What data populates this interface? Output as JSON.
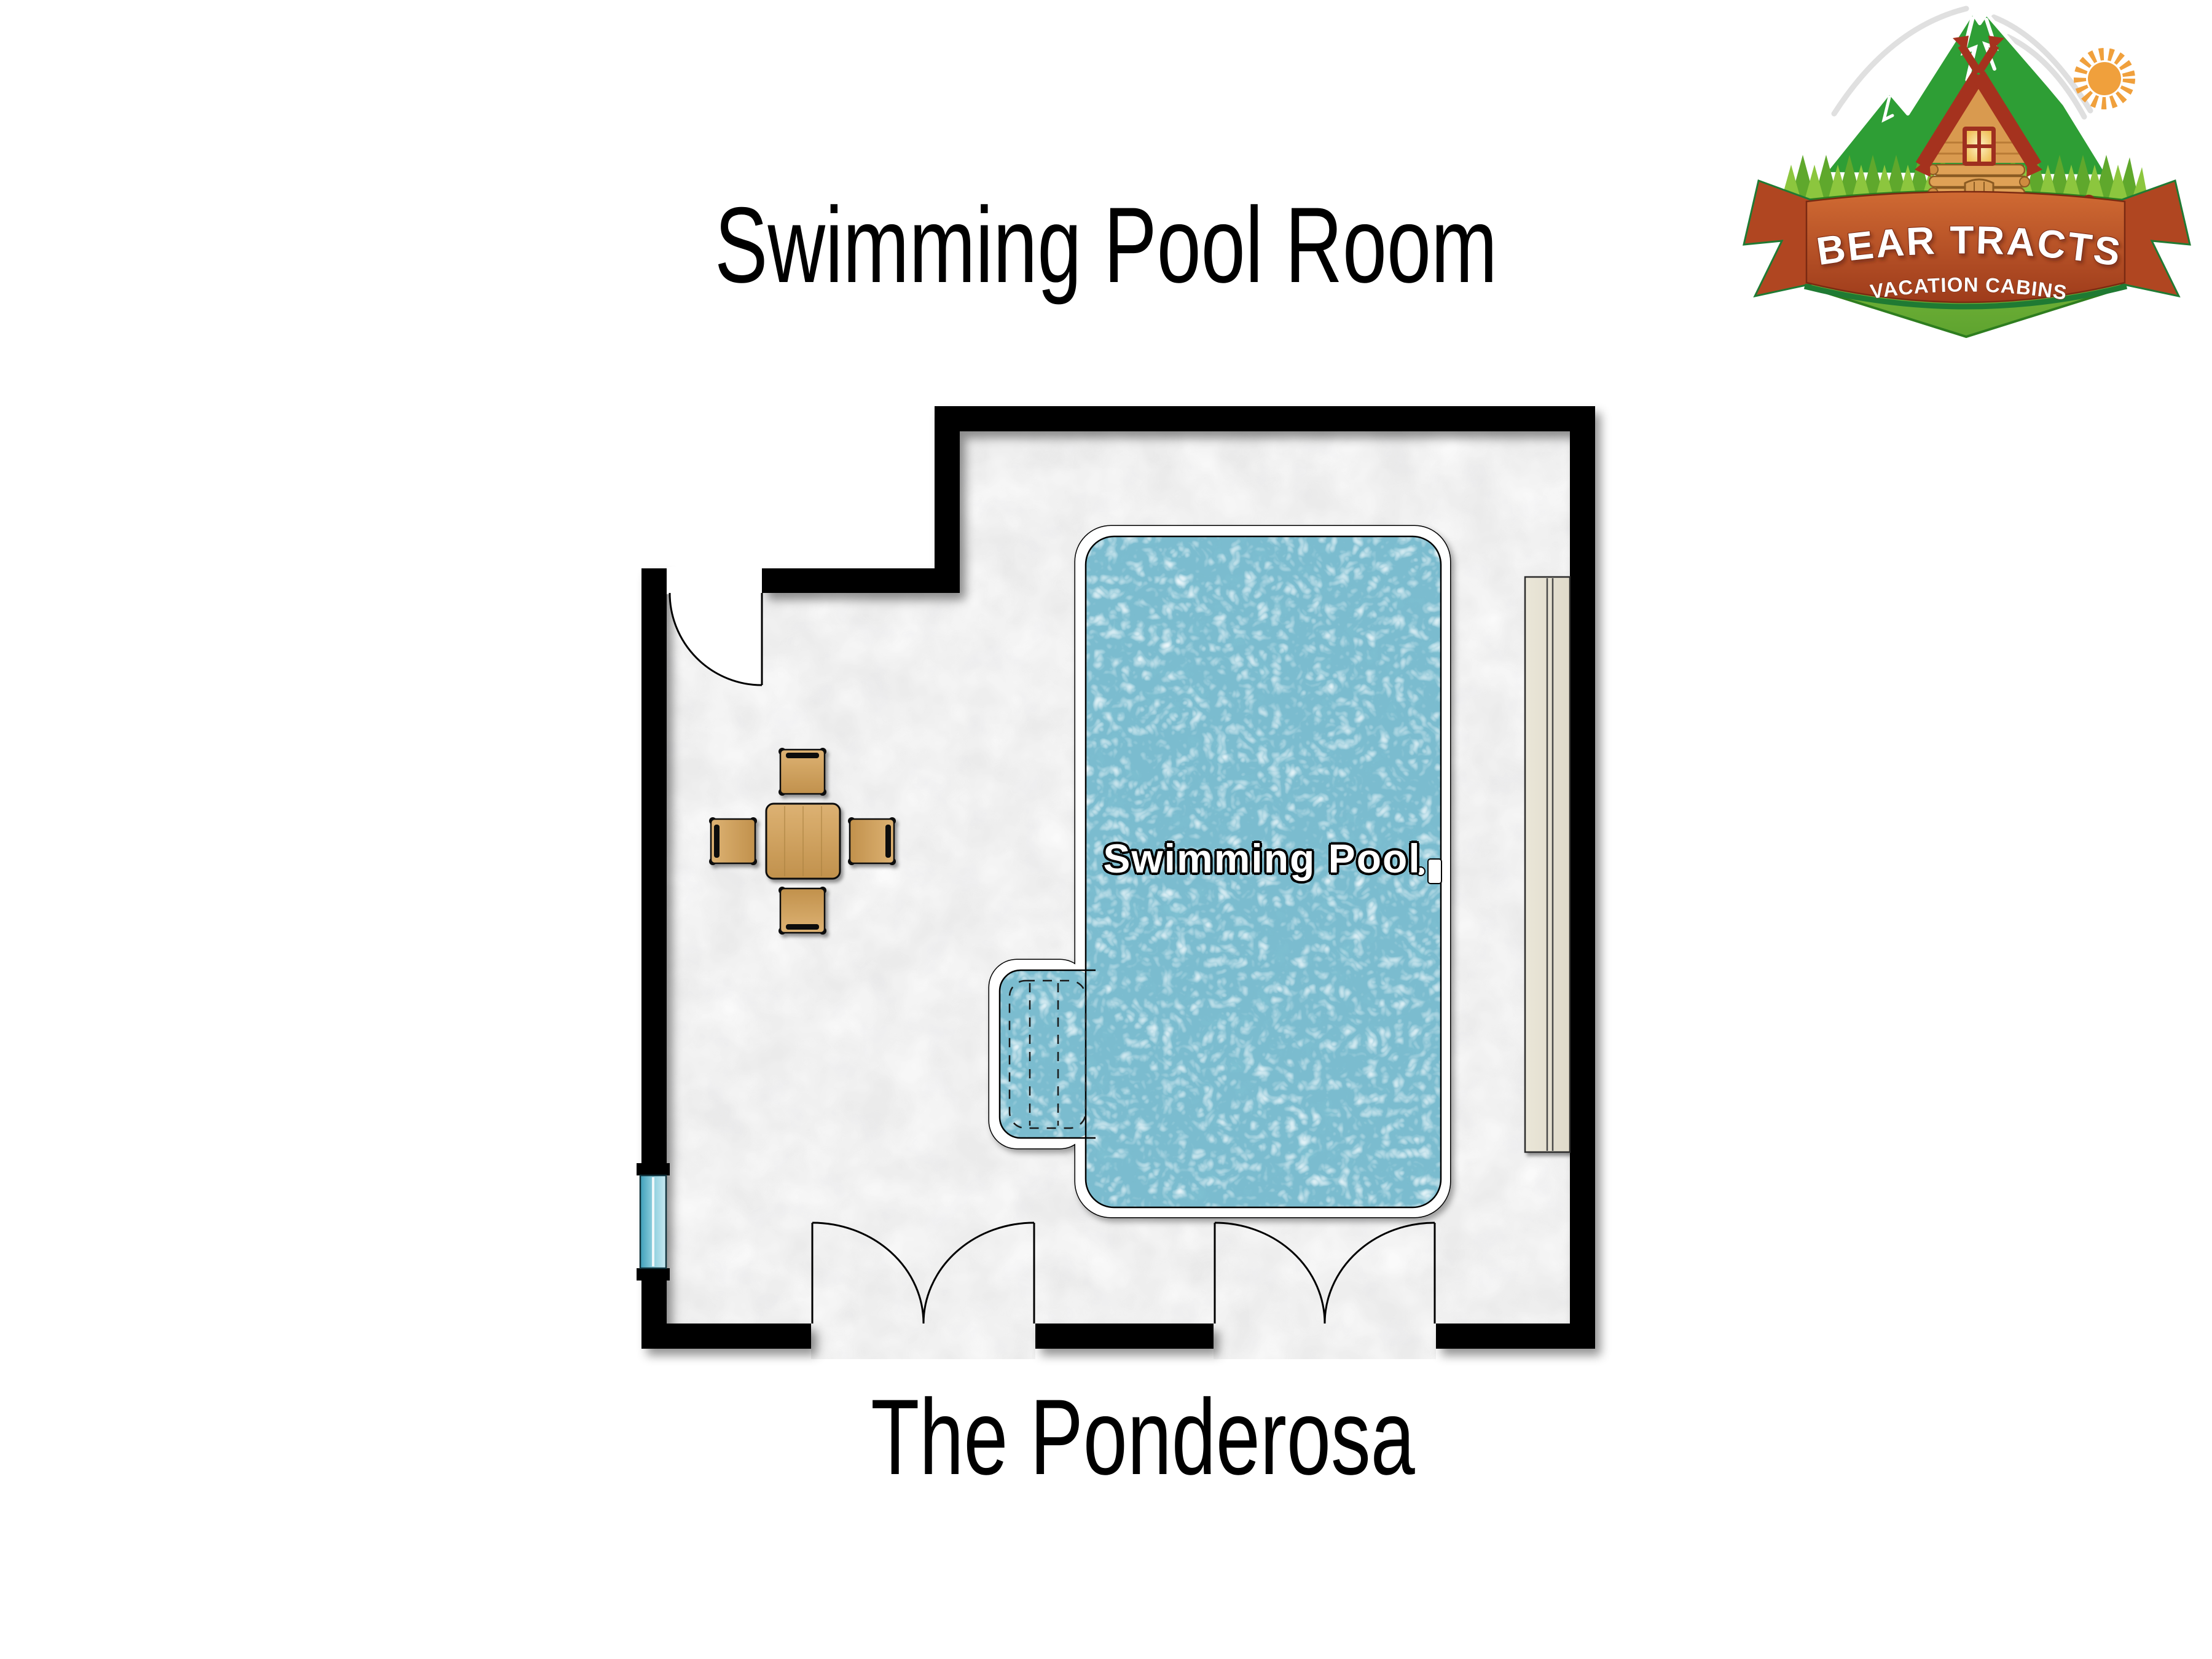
{
  "page": {
    "title": "Swimming Pool Room",
    "subtitle": "The Ponderosa",
    "background_color": "#FFFFFF"
  },
  "floor_plan": {
    "pool_label": "Swimming Pool",
    "colors": {
      "wall": "#000000",
      "floor_base": "#EBEBEB",
      "floor_mottle": "#D4D4D6",
      "pool_water": "#7BBCCF",
      "pool_border": "#FFFFFF",
      "window_glass": "#58B2C9",
      "counter": "#E7E2D3",
      "wood": "#D2A75F"
    },
    "features": [
      "entry-door",
      "double-door-left",
      "double-door-right",
      "window",
      "swimming-pool",
      "pool-steps",
      "pool-ladder",
      "dining-table",
      "four-chairs",
      "counter"
    ]
  },
  "logo": {
    "primary_text": "BEAR TRACTS",
    "secondary_text": "VACATION CABINS",
    "colors": {
      "mountain": "#2E9E35",
      "trees_light": "#8CC63E",
      "trees_dark": "#5FA82C",
      "hill": "#7CBE3D",
      "banner_top": "#CE6430",
      "banner_bottom": "#9E3B1B",
      "banner_trim": "#1F7A33",
      "sun": "#F0A03C",
      "bear": "#8E2B16",
      "cabin_logs": "#DFA156",
      "roof": "#A5321E"
    }
  }
}
